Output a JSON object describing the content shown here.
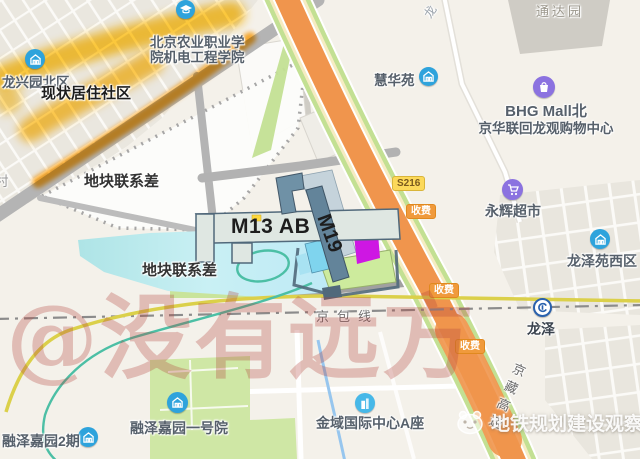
{
  "labels": {
    "longxingyuan": "龙兴园北区",
    "status_community": "现状居住社区",
    "village_partial": "村",
    "college_line1": "北京农业职业学",
    "college_line2": "院机电工程学院",
    "tongdayuan": "通达园",
    "road_long_partial": "龙",
    "huihuayuan": "慧华苑",
    "bhg_line1": "BHG Mall北",
    "bhg_line2": "京华联回龙观购物中心",
    "parcel_gap": "地块联系差",
    "m13": "M13 AB",
    "m19": "M19",
    "s216": "S216",
    "toll": "收费",
    "yonghui": "永辉超市",
    "longzeyuan_west": "龙泽苑西区",
    "longze": "龙泽",
    "jingbao": "京包线",
    "jingzang": "京藏高速",
    "rongze_phase2": "融泽嘉园2期",
    "rongze_no1": "融泽嘉园一号院",
    "jinyu": "金域国际中心A座"
  },
  "watermarks": {
    "center": "@没有远方",
    "corner": "地铁规划建设观察"
  },
  "icons": {
    "longxingyuan": "estate-icon",
    "college": "school-icon",
    "huihuayuan": "estate-icon",
    "bhg": "mall-icon",
    "yonghui": "supermarket-icon",
    "longzeyuan_west": "estate-icon",
    "longze": "beijing-subway-logo",
    "rongze_phase2": "estate-icon",
    "rongze_no1": "estate-icon",
    "jinyu": "office-icon",
    "corner_logo": "mascot-logo"
  },
  "colors": {
    "bg": "#f4f1ea",
    "block": "#eae7df",
    "road_gray": "#b4b4b4",
    "poi_text": "#56606b",
    "water": "#c3ebf0",
    "highway_orange": "#f0954d",
    "highway_side": "#f6ecc2",
    "verge_green": "#c3e093",
    "metro13_yellow": "#dbd04a",
    "greenway_teal": "#4cbfa5",
    "stream_blue": "#97c6ee",
    "rail_gray": "#8b8b8b",
    "station_slate": "#51697b",
    "station_panel": "#dfe7e2",
    "station_band": "#6f91a6",
    "station_cyan": "#7fd4ee",
    "station_magenta": "#ce17e3",
    "station_pad": "#cdeb9d",
    "highlight_yellow": "#ffc21e",
    "highlight_orange": "#ff9d00",
    "badge_toll": "#f09a3c",
    "watermark_red": "#b2423a",
    "poi_blue": "#2ea3dc",
    "poi_purple": "#8b72e0",
    "subway_blue": "#2a61ad"
  }
}
